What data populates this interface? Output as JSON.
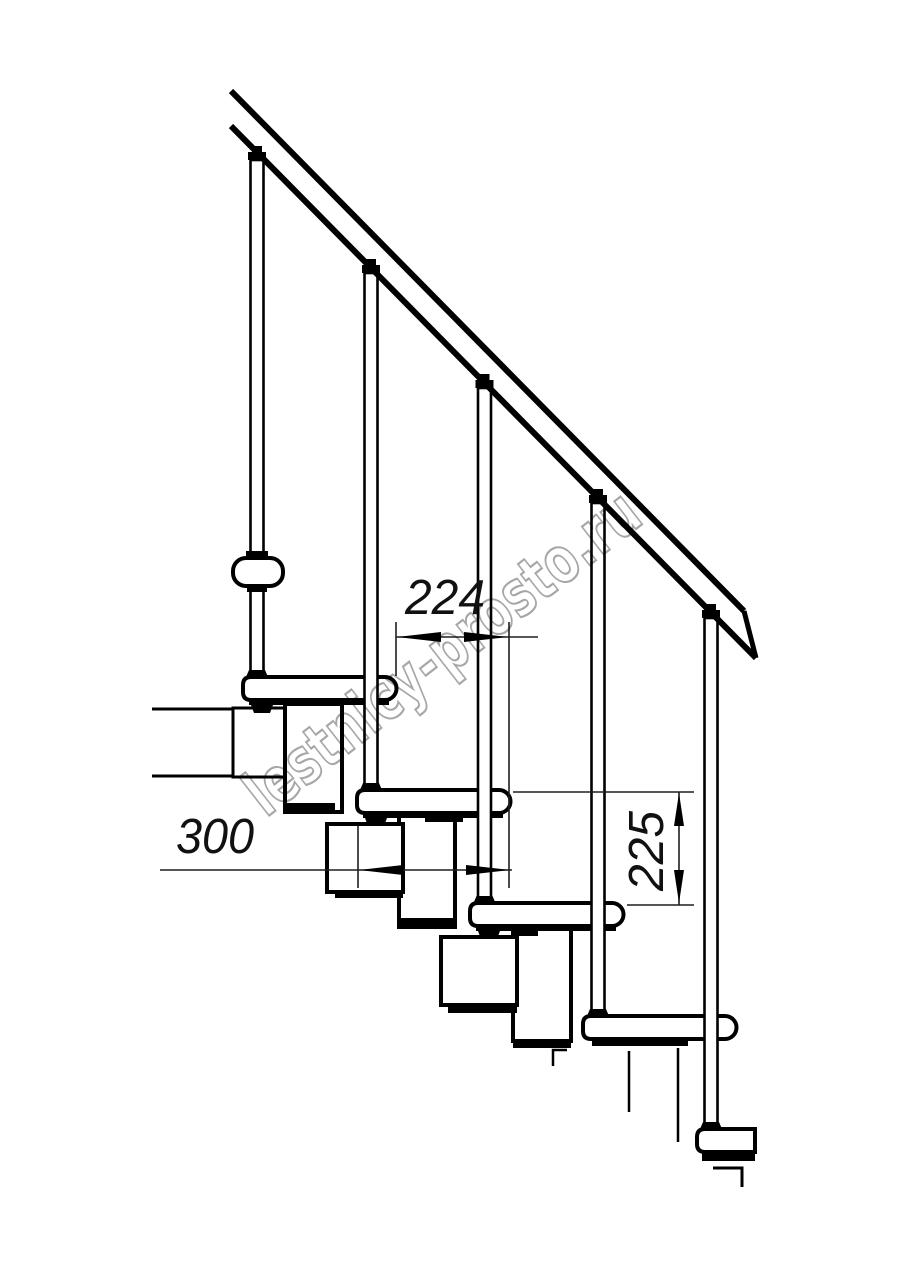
{
  "diagram": {
    "title": "modular-staircase-side-view",
    "background": "#ffffff",
    "ink_color": "#000000",
    "dimension_color": "#1f1f1f",
    "watermark_color": "#989898",
    "watermark_text": "lestnicy-prosto.ru",
    "dimensions": {
      "going_horizontal": "224",
      "tread_depth": "300",
      "rise_vertical": "225"
    },
    "counts": {
      "treads": 5,
      "balusters": 5
    }
  }
}
